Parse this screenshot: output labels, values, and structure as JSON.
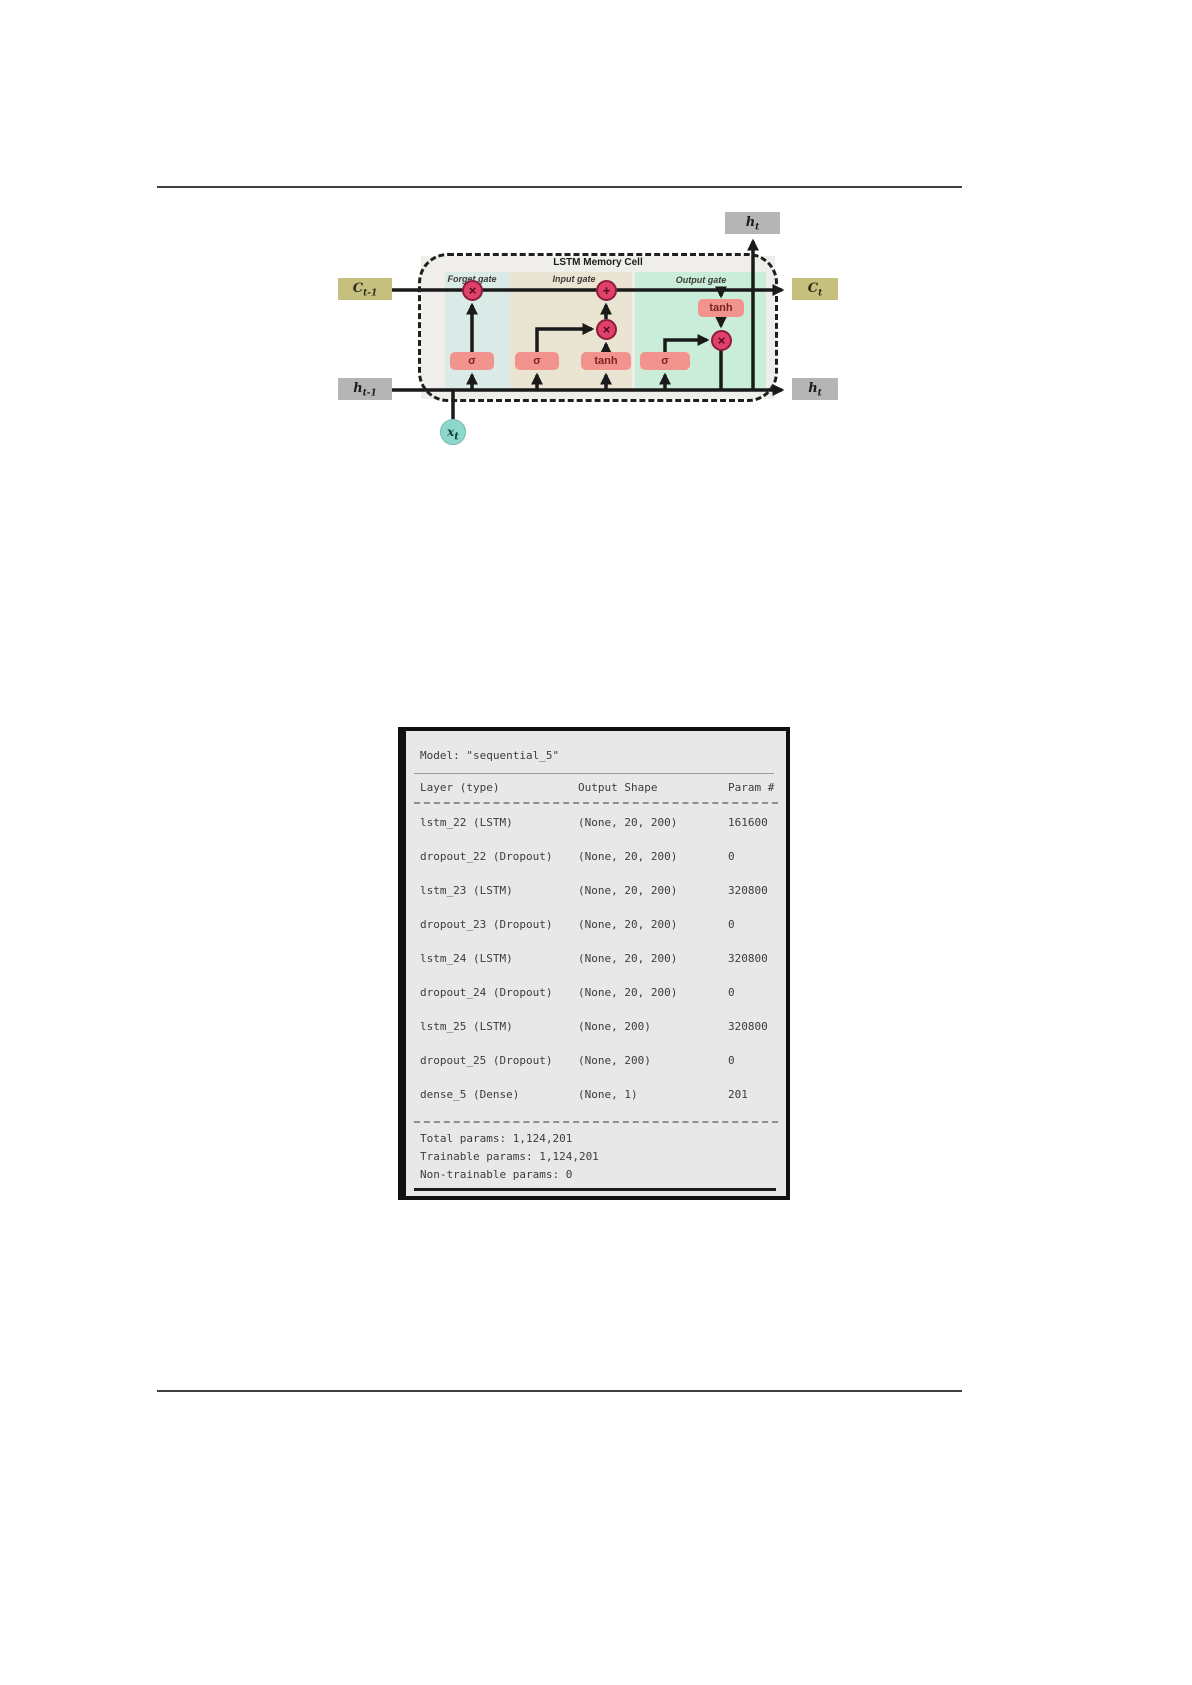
{
  "figure": {
    "title": "LSTM Memory Cell",
    "gate_labels": {
      "forget": "Forget gate",
      "input": "Input gate",
      "output": "Output gate"
    },
    "io": {
      "c_prev": {
        "base": "C",
        "sub": "t-1"
      },
      "c_next": {
        "base": "C",
        "sub": "t"
      },
      "h_prev": {
        "base": "h",
        "sub": "t-1"
      },
      "h_top": {
        "base": "h",
        "sub": "t"
      },
      "h_right": {
        "base": "h",
        "sub": "t"
      },
      "x_in": {
        "base": "x",
        "sub": "t"
      }
    },
    "ops": {
      "sigma": "σ",
      "tanh": "tanh",
      "multiply": "×",
      "add": "+"
    },
    "colors": {
      "cell_state_box": "#c6c07e",
      "hidden_state_box": "#b5b5b5",
      "activation_box": "#f2938d",
      "operation_circle": "#df4168",
      "input_circle": "#8ed7cc",
      "forget_region": "#d9eae7",
      "input_region": "#e9e5d2",
      "output_region": "#c9edd9"
    }
  },
  "model_summary": {
    "model_line": "Model: \"sequential_5\"",
    "columns": {
      "layer": "Layer (type)",
      "output_shape": "Output Shape",
      "params": "Param #"
    },
    "rows": [
      {
        "layer": "lstm_22 (LSTM)",
        "output_shape": "(None, 20, 200)",
        "params": "161600"
      },
      {
        "layer": "dropout_22 (Dropout)",
        "output_shape": "(None, 20, 200)",
        "params": "0"
      },
      {
        "layer": "lstm_23 (LSTM)",
        "output_shape": "(None, 20, 200)",
        "params": "320800"
      },
      {
        "layer": "dropout_23 (Dropout)",
        "output_shape": "(None, 20, 200)",
        "params": "0"
      },
      {
        "layer": "lstm_24 (LSTM)",
        "output_shape": "(None, 20, 200)",
        "params": "320800"
      },
      {
        "layer": "dropout_24 (Dropout)",
        "output_shape": "(None, 20, 200)",
        "params": "0"
      },
      {
        "layer": "lstm_25 (LSTM)",
        "output_shape": "(None, 200)",
        "params": "320800"
      },
      {
        "layer": "dropout_25 (Dropout)",
        "output_shape": "(None, 200)",
        "params": "0"
      },
      {
        "layer": "dense_5 (Dense)",
        "output_shape": "(None, 1)",
        "params": "201"
      }
    ],
    "totals": {
      "total": "Total params: 1,124,201",
      "trainable": "Trainable params: 1,124,201",
      "non_trainable": "Non-trainable params: 0"
    }
  }
}
